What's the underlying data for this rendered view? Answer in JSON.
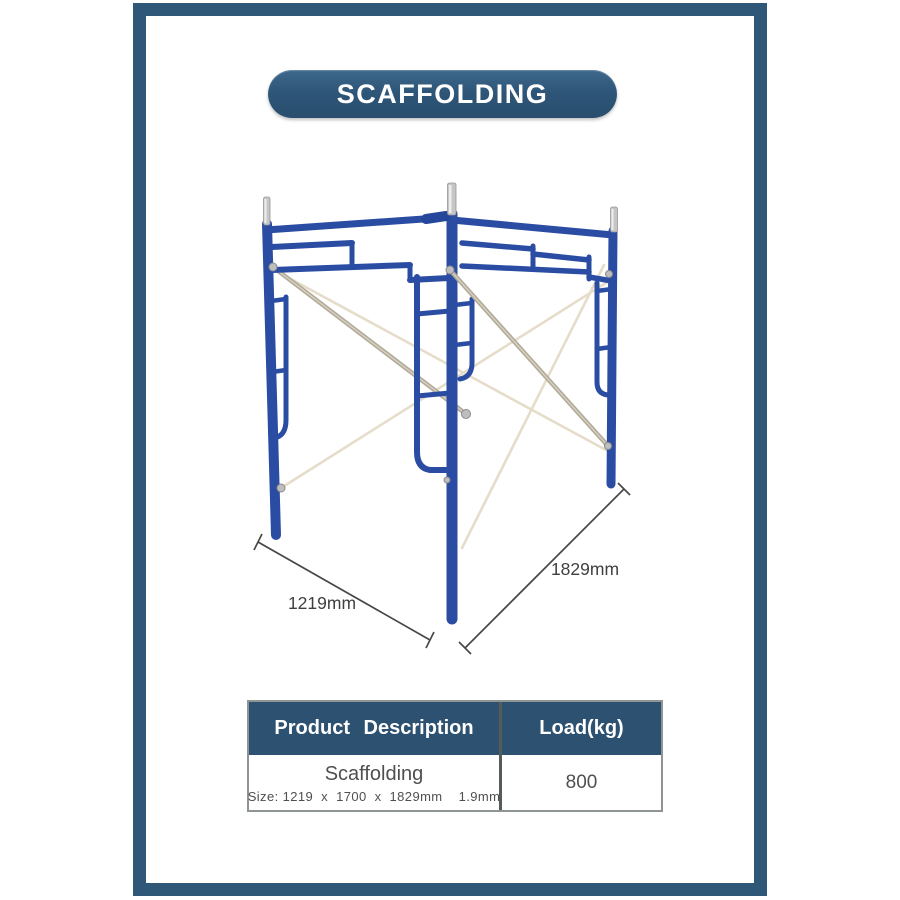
{
  "banner": {
    "title": "SCAFFOLDING",
    "bg_color": "#2E5678",
    "text_color": "#FFFFFF"
  },
  "diagram": {
    "width_label": "1219mm",
    "length_label": "1829mm",
    "steel_blue": "#2A4DA3",
    "brace_silver": "#B3AB99",
    "brace_cream": "#E5DDCA",
    "pin_silver": "#C6C6C6",
    "dimension_line_color": "#474747"
  },
  "page": {
    "frame_color": "#2F5878",
    "background": "#FFFFFF"
  },
  "table": {
    "header_bg": "#2D5170",
    "headers": [
      {
        "label": "Product Description"
      },
      {
        "label": "Load(kg)"
      }
    ],
    "rows": [
      {
        "product": "Scaffolding",
        "size": "Size: 1219  x  1700  x  1829mm    1.9mm",
        "load": "800"
      }
    ]
  }
}
